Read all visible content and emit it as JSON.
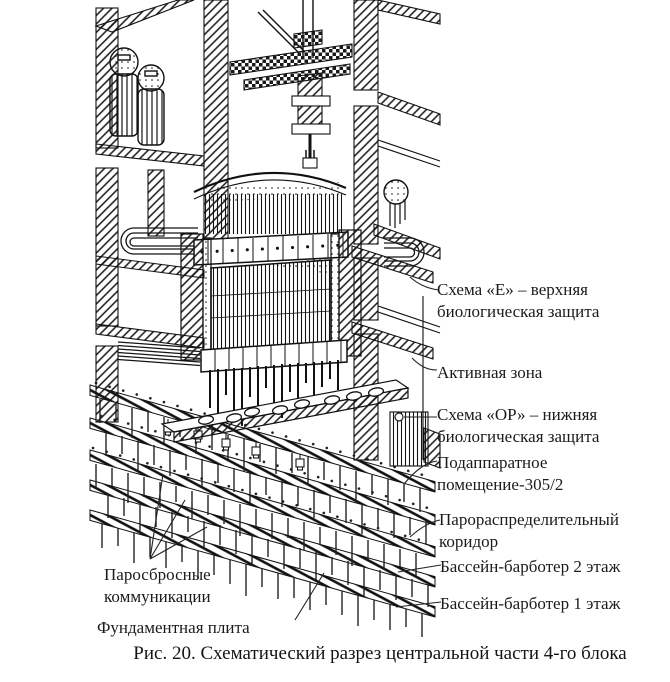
{
  "colors": {
    "ink": "#1b1b1b",
    "background": "#ffffff"
  },
  "figure": {
    "caption": "Рис. 20. Схематический разрез центральной части 4-го блока",
    "labels": {
      "upper_shield": "Схема «Е» – верхняя биологическая защита",
      "core": "Активная зона",
      "lower_shield": "Схема «ОР» – нижняя биологическая защита",
      "subreactor_room": "Подаппаратное помещение-305/2",
      "steam_corridor": "Парораспределительный коридор",
      "bubbler_pool_2": "Бассейн-барботер 2 этаж",
      "bubbler_pool_1": "Бассейн-барботер 1 этаж",
      "steam_dump_lines": "Паросбросные коммуникации",
      "foundation_plate": "Фундаментная плита"
    }
  }
}
